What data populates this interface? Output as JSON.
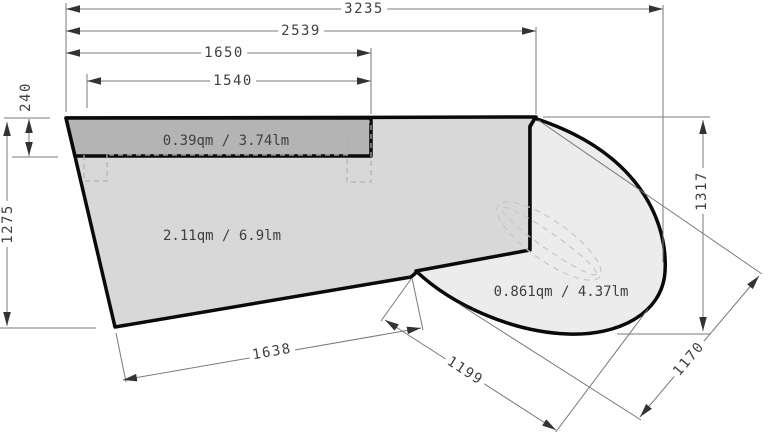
{
  "drawing": {
    "kind": "dimensioned technical plan (countertop / floor plan)",
    "units_note": "qm = square meters, lm = linear meters",
    "dims": {
      "overall_width": "3235",
      "width_to_bay": "2539",
      "strip_width_outer": "1650",
      "strip_width_inner": "1540",
      "strip_depth": "240",
      "left_height": "1275",
      "right_height": "1317",
      "bottom_edge": "1638",
      "diagonal_edge": "1199",
      "bay_width": "1170"
    },
    "areas": {
      "strip_label": "0.39qm / 3.74lm",
      "main_label": "2.11qm / 6.9lm",
      "bay_label": "0.861qm / 4.37lm"
    },
    "colors": {
      "strip_fill": "#b4b4b4",
      "main_fill": "#d8d8d8",
      "bay_fill": "#ececec",
      "outline": "#0a0a0a",
      "dim_line": "#7a7a7a",
      "arrow": "#333333",
      "dim_text": "#3f3f3f",
      "dashed_cabinet": "#b0b0b0",
      "dashed_sink": "#c6c6c6"
    }
  }
}
